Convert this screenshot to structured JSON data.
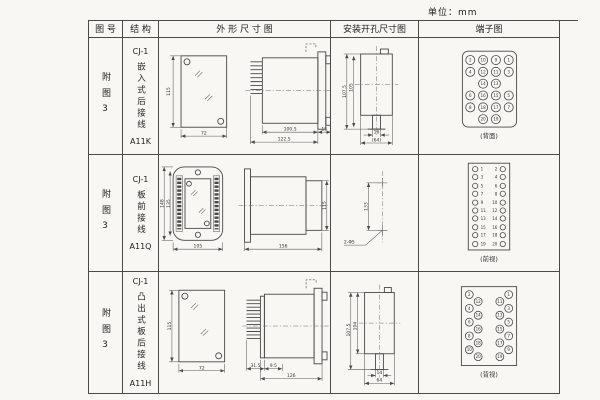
{
  "page": {
    "unit_label": "单位：mm"
  },
  "table": {
    "headers": {
      "fig": "图 号",
      "struct": "结 构",
      "outline": "外 形 尺 寸 图",
      "mounting": "安装开孔尺寸图",
      "terminal": "端子图"
    },
    "rows": [
      {
        "fig_no": "附图3",
        "model": "CJ-1",
        "structure": "嵌入式后接线",
        "code": "A11K",
        "outline": {
          "front_height": "115",
          "front_width": "72",
          "body_len": "100.5",
          "flange": "15",
          "total_len": "122.5"
        },
        "mounting": {
          "outer_h": "107.5",
          "inner_h": "105",
          "slot_w": "16",
          "outer_w": "(64)"
        },
        "terminal": {
          "view_label": "(背面)",
          "pins": [
            [
              52,
              22,
              "2"
            ],
            [
              65,
              22,
              "10"
            ],
            [
              78,
              22,
              "9"
            ],
            [
              91,
              22,
              "1"
            ],
            [
              52,
              34,
              "4"
            ],
            [
              65,
              34,
              "12"
            ],
            [
              78,
              34,
              "11"
            ],
            [
              91,
              34,
              "3"
            ],
            [
              65,
              46,
              "14"
            ],
            [
              78,
              46,
              "13"
            ],
            [
              52,
              58,
              "6"
            ],
            [
              65,
              58,
              "16"
            ],
            [
              78,
              58,
              "15"
            ],
            [
              91,
              58,
              "5"
            ],
            [
              52,
              70,
              "8"
            ],
            [
              65,
              70,
              "18"
            ],
            [
              78,
              70,
              "17"
            ],
            [
              91,
              70,
              "7"
            ],
            [
              65,
              82,
              "20"
            ],
            [
              78,
              82,
              "19"
            ]
          ]
        }
      },
      {
        "fig_no": "附图3",
        "model": "CJ-1",
        "structure": "板前接线",
        "code": "A11Q",
        "outline": {
          "outer_h": "148",
          "inner_h": "135",
          "width": "105",
          "depth": "156",
          "side_h": "115"
        },
        "mounting": {
          "hole_dist": "133",
          "holes": "2-Φ5"
        },
        "terminal": {
          "view_label": "(前视)",
          "pins": [
            [
              57,
              14
            ],
            [
              85,
              14
            ],
            [
              57,
              22
            ],
            [
              85,
              22
            ],
            [
              57,
              31
            ],
            [
              85,
              31
            ],
            [
              57,
              39
            ],
            [
              85,
              39
            ],
            [
              57,
              48
            ],
            [
              85,
              48
            ],
            [
              57,
              56
            ],
            [
              85,
              56
            ],
            [
              57,
              64
            ],
            [
              85,
              64
            ],
            [
              57,
              73
            ],
            [
              85,
              73
            ],
            [
              57,
              81
            ],
            [
              85,
              81
            ],
            [
              57,
              90
            ],
            [
              85,
              90
            ]
          ],
          "nums": [
            [
              62.5,
              15.6,
              "1",
              "start"
            ],
            [
              79.5,
              15.6,
              "2",
              "end"
            ],
            [
              62.5,
              23.6,
              "3",
              "start"
            ],
            [
              79.5,
              23.6,
              "4",
              "end"
            ],
            [
              62.5,
              32.6,
              "5",
              "start"
            ],
            [
              79.5,
              32.6,
              "6",
              "end"
            ],
            [
              62.5,
              40.6,
              "7",
              "start"
            ],
            [
              79.5,
              40.6,
              "8",
              "end"
            ],
            [
              62.5,
              49.6,
              "9",
              "start"
            ],
            [
              79.5,
              49.6,
              "10",
              "end"
            ],
            [
              62.5,
              57.6,
              "11",
              "start"
            ],
            [
              79.5,
              57.6,
              "12",
              "end"
            ],
            [
              62.5,
              65.6,
              "13",
              "start"
            ],
            [
              79.5,
              65.6,
              "14",
              "end"
            ],
            [
              62.5,
              74.6,
              "15",
              "start"
            ],
            [
              79.5,
              74.6,
              "16",
              "end"
            ],
            [
              62.5,
              82.6,
              "17",
              "start"
            ],
            [
              79.5,
              82.6,
              "18",
              "end"
            ],
            [
              62.5,
              91.6,
              "19",
              "start"
            ],
            [
              79.5,
              91.6,
              "20",
              "end"
            ]
          ]
        }
      },
      {
        "fig_no": "附图3",
        "model": "CJ-1",
        "structure": "凸出式板后接线",
        "code": "A11H",
        "outline": {
          "front_height": "115",
          "front_width": "72",
          "pins_len": "31.5",
          "gap": "9.5",
          "body_len": "126"
        },
        "mounting": {
          "outer_h": "107.5",
          "inner_h": "104",
          "slot_w": "14",
          "outer_w": "64"
        },
        "terminal": {
          "view_label": "(背视)",
          "pins": [
            [
              51,
              20,
              "2"
            ],
            [
              51,
              34,
              "4"
            ],
            [
              51,
              48,
              "6"
            ],
            [
              51,
              62,
              "8"
            ],
            [
              51,
              76,
              "10"
            ],
            [
              60,
              27,
              "12"
            ],
            [
              60,
              41,
              "14"
            ],
            [
              60,
              55,
              "16"
            ],
            [
              60,
              69,
              "18"
            ],
            [
              60,
              83,
              "20"
            ],
            [
              82,
              27,
              "11"
            ],
            [
              82,
              41,
              "13"
            ],
            [
              82,
              55,
              "15"
            ],
            [
              82,
              69,
              "17"
            ],
            [
              82,
              83,
              "19"
            ],
            [
              91,
              20,
              "1"
            ],
            [
              91,
              34,
              "3"
            ],
            [
              91,
              48,
              "5"
            ],
            [
              91,
              62,
              "7"
            ],
            [
              91,
              76,
              "9"
            ]
          ]
        }
      }
    ]
  }
}
